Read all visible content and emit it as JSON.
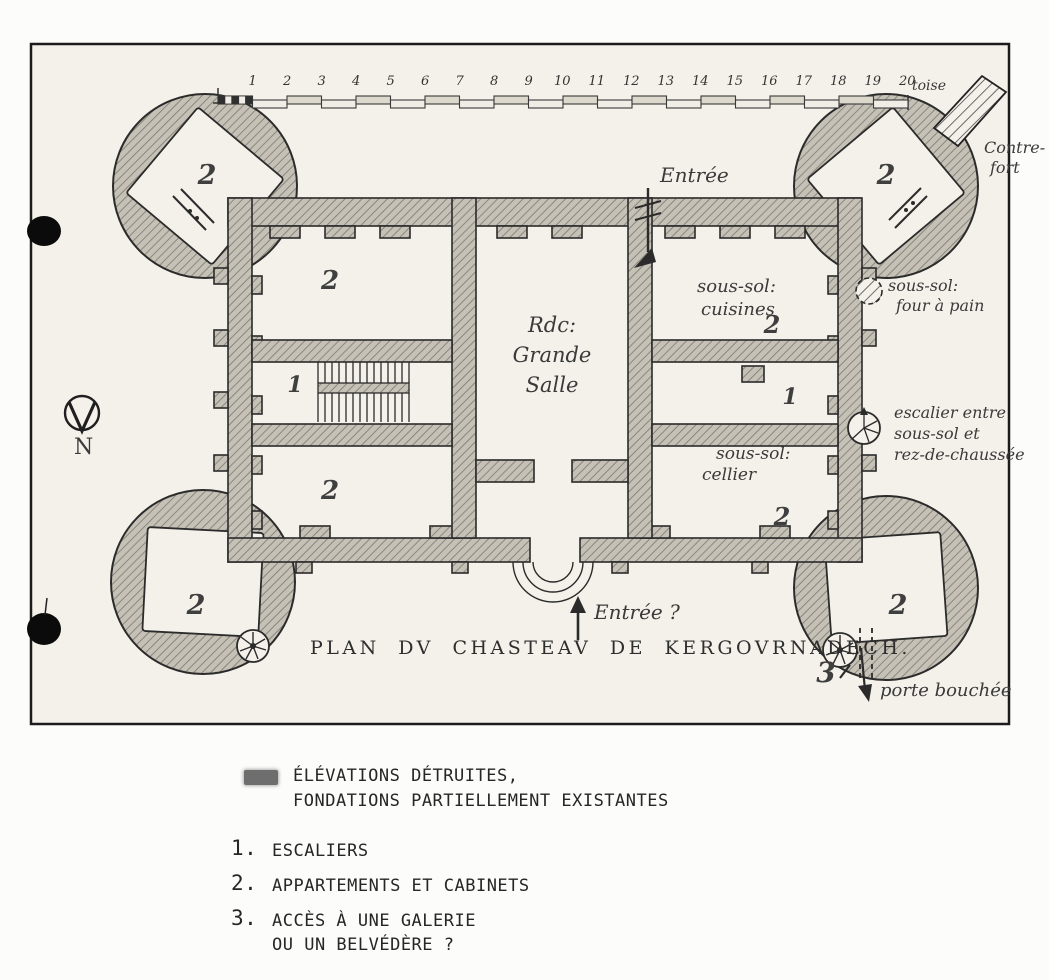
{
  "plan": {
    "title": "PLAN DV CHASTEAV DE KERGOVRNADECH.",
    "compass": "N",
    "scale_numbers": [
      "1",
      "2",
      "3",
      "4",
      "5",
      "6",
      "7",
      "8",
      "9",
      "10",
      "11",
      "12",
      "13",
      "14",
      "15",
      "16",
      "17",
      "18",
      "19",
      "20"
    ],
    "scale_unit": "toise",
    "labels": {
      "entree_top": "Entrée",
      "entree_bottom": "Entrée ?",
      "contrefort": [
        "Contre-",
        "fort"
      ],
      "cuisines": [
        "sous-sol:",
        "cuisines"
      ],
      "four_a_pain": [
        "sous-sol:",
        "four à pain"
      ],
      "grande_salle": [
        "Rdc:",
        "Grande",
        "Salle"
      ],
      "escalier_note": [
        "escalier entre",
        "sous-sol et",
        "rez-de-chaussée"
      ],
      "cellier": [
        "sous-sol:",
        "cellier"
      ],
      "porte_bouchee": "porte bouchée"
    },
    "room_numbers": {
      "tower_nw": "2",
      "tower_ne": "2",
      "tower_sw": "2",
      "tower_se": "2",
      "west_wing_north": "2",
      "west_wing_stairs": "1",
      "west_wing_south": "2",
      "east_wing_cuisines": "2",
      "east_wing_corridor": "1",
      "east_wing_cellier": "2",
      "gallery_access": "3"
    }
  },
  "legend": {
    "swatch_color": "#6e6e6e",
    "destroyed_lines": [
      "ÉLÉVATIONS DÉTRUITES,",
      "FONDATIONS PARTIELLEMENT EXISTANTES"
    ],
    "items": [
      {
        "num": "1.",
        "lines": [
          "ESCALIERS"
        ]
      },
      {
        "num": "2.",
        "lines": [
          "APPARTEMENTS ET CABINETS"
        ]
      },
      {
        "num": "3.",
        "lines": [
          "ACCÈS À UNE GALERIE",
          "OU UN BELVÉDÈRE ?"
        ]
      }
    ]
  }
}
